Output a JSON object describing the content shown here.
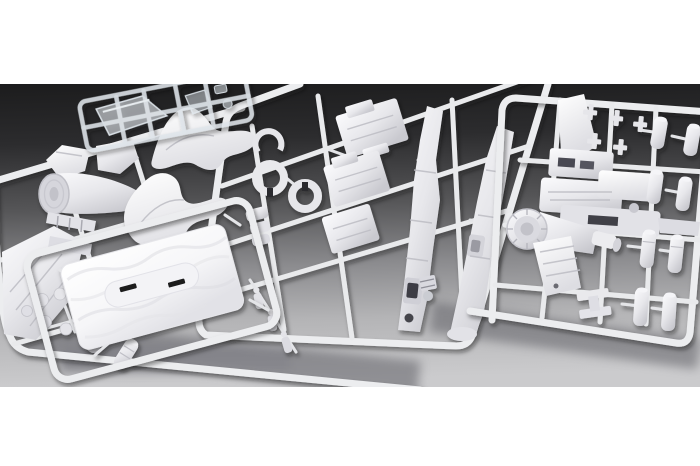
{
  "meta": {
    "type": "product-photograph",
    "photo_alt": "Product photo of an unassembled plastic scale-model kit: five overlapping injection-moulded sprues of white polystyrene aircraft parts and one small clear canopy sprue, lit on a gray studio background that fades from near-black at the top to light gray at the bottom, framed by white bands above and below",
    "text_content": "none visible in photo"
  },
  "palette": {
    "frame_white": "#ffffff",
    "background_top": "#1c1c1d",
    "background_bottom": "#cbcbcd",
    "plastic_base": "#ebebee",
    "plastic_highlight": "#fbfbfd",
    "plastic_shadow": "#a9a9b0",
    "clear_part_tint": "#dfe7ee",
    "slot_dark": "#1b1b1f"
  },
  "layout": {
    "canvas_width": 700,
    "canvas_height": 466,
    "photo_band_top": 84,
    "photo_band_bottom": 387
  },
  "sprues": [
    {
      "id": "clear-canopy-sprue",
      "name": "small clear sprue with cockpit canopy and windshield parts",
      "position": "top-left",
      "plastic": "transparent"
    },
    {
      "id": "left-sprue",
      "name": "white sprue with nose section, engine cowling, wing panel, round wheels and two ribbed cylinders",
      "position": "left",
      "plastic": "white"
    },
    {
      "id": "center-sprue",
      "name": "white sprue with two curved hull saddle panels, two split ring parts, stepped plates and two long tapered fuselage halves",
      "position": "center",
      "plastic": "white"
    },
    {
      "id": "base-plate-sprue",
      "name": "white sprue holding a large textured rectangular base plate with two dark slots",
      "position": "bottom-left",
      "plastic": "white"
    },
    {
      "id": "right-sprue",
      "name": "white sprue with tail fin, engine block, ribbed thruster cone, finned wing plate and eight torpedo-shaped cylinders",
      "position": "right",
      "plastic": "white"
    }
  ],
  "part_counts": {
    "curved_hull_panels": 2,
    "fuselage_halves": 2,
    "split_rings": 2,
    "torpedo_cylinders": 8,
    "small_round_knobs": 6,
    "crew_figures": 3,
    "base_plates": 1,
    "clear_canopies": 2
  }
}
